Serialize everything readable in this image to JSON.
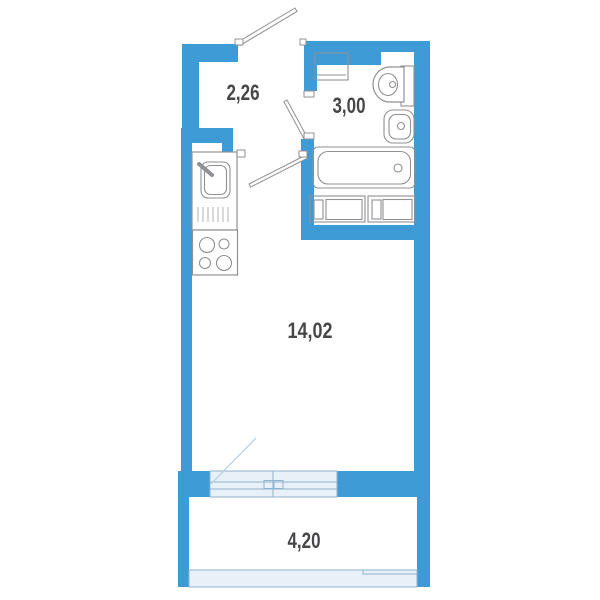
{
  "plan": {
    "rooms": [
      {
        "id": "hallway",
        "area_label": "2,26"
      },
      {
        "id": "bathroom",
        "area_label": "3,00"
      },
      {
        "id": "living-room",
        "area_label": "14,02"
      },
      {
        "id": "balcony",
        "area_label": "4,20"
      }
    ],
    "colors": {
      "wall": "#3f9bd5",
      "glazing_fill": "#e9f1f8",
      "glazing_stroke": "#8fb3cc",
      "fixture_stroke": "#8f9194",
      "label": "#47474a",
      "swing_line": "#b5cede"
    }
  }
}
